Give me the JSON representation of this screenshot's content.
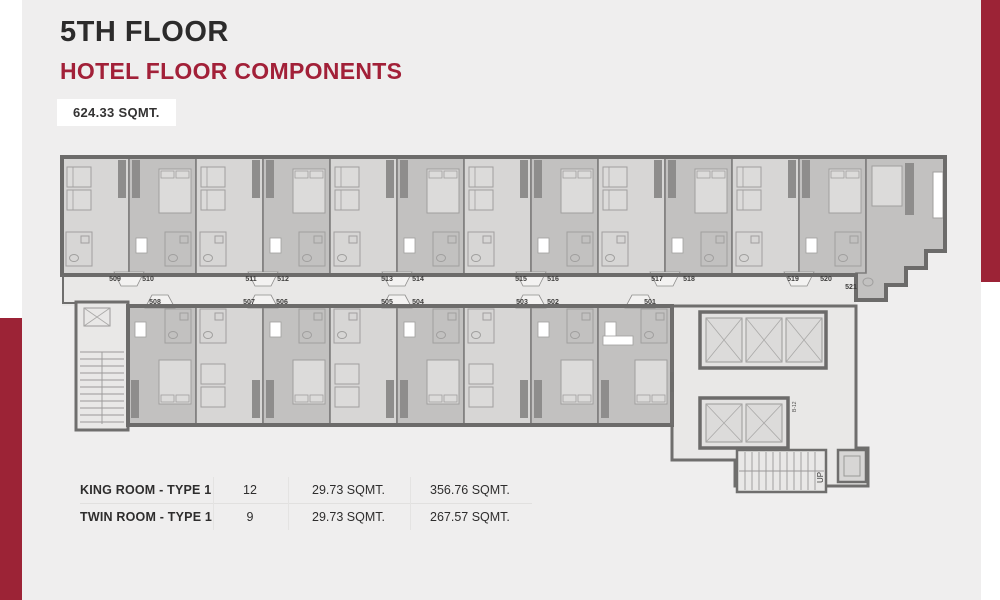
{
  "colors": {
    "accent_red": "#9c2336",
    "heading_red": "#a22038",
    "bg": "#efeeee"
  },
  "header": {
    "title": "5TH FLOOR",
    "subtitle": "HOTEL FLOOR COMPONENTS",
    "area_badge": "624.33 SQMT."
  },
  "plan": {
    "top_rooms": [
      {
        "no": "509",
        "kind": "twin",
        "lx": 109
      },
      {
        "no": "510",
        "kind": "king",
        "lx": 142
      },
      {
        "no": "511",
        "kind": "twin",
        "lx": 245
      },
      {
        "no": "512",
        "kind": "king",
        "lx": 277
      },
      {
        "no": "513",
        "kind": "twin",
        "lx": 381
      },
      {
        "no": "514",
        "kind": "king",
        "lx": 412
      },
      {
        "no": "515",
        "kind": "twin",
        "lx": 515
      },
      {
        "no": "516",
        "kind": "king",
        "lx": 547
      },
      {
        "no": "517",
        "kind": "twin",
        "lx": 651
      },
      {
        "no": "518",
        "kind": "king",
        "lx": 683
      },
      {
        "no": "519",
        "kind": "twin",
        "lx": 787
      },
      {
        "no": "520",
        "kind": "king",
        "lx": 820
      },
      {
        "no": "521",
        "kind": "king",
        "lx": 845,
        "ly": 289
      }
    ],
    "bottom_rooms": [
      {
        "no": "508",
        "kind": "king",
        "lx": 149
      },
      {
        "no": "507",
        "kind": "twin",
        "lx": 243
      },
      {
        "no": "506",
        "kind": "king",
        "lx": 276
      },
      {
        "no": "505",
        "kind": "twin",
        "lx": 381
      },
      {
        "no": "504",
        "kind": "king",
        "lx": 412
      },
      {
        "no": "503",
        "kind": "twin",
        "lx": 516
      },
      {
        "no": "502",
        "kind": "king",
        "lx": 547
      },
      {
        "no": "501",
        "kind": "king",
        "lx": 644
      }
    ],
    "stair_label": "UP",
    "shaft_label": "B-12"
  },
  "table": {
    "rows": [
      {
        "name": "KING ROOM - TYPE 1",
        "count": "12",
        "unit_area": "29.73 SQMT.",
        "total_area": "356.76 SQMT."
      },
      {
        "name": "TWIN ROOM - TYPE 1",
        "count": "9",
        "unit_area": "29.73 SQMT.",
        "total_area": "267.57 SQMT."
      }
    ]
  }
}
